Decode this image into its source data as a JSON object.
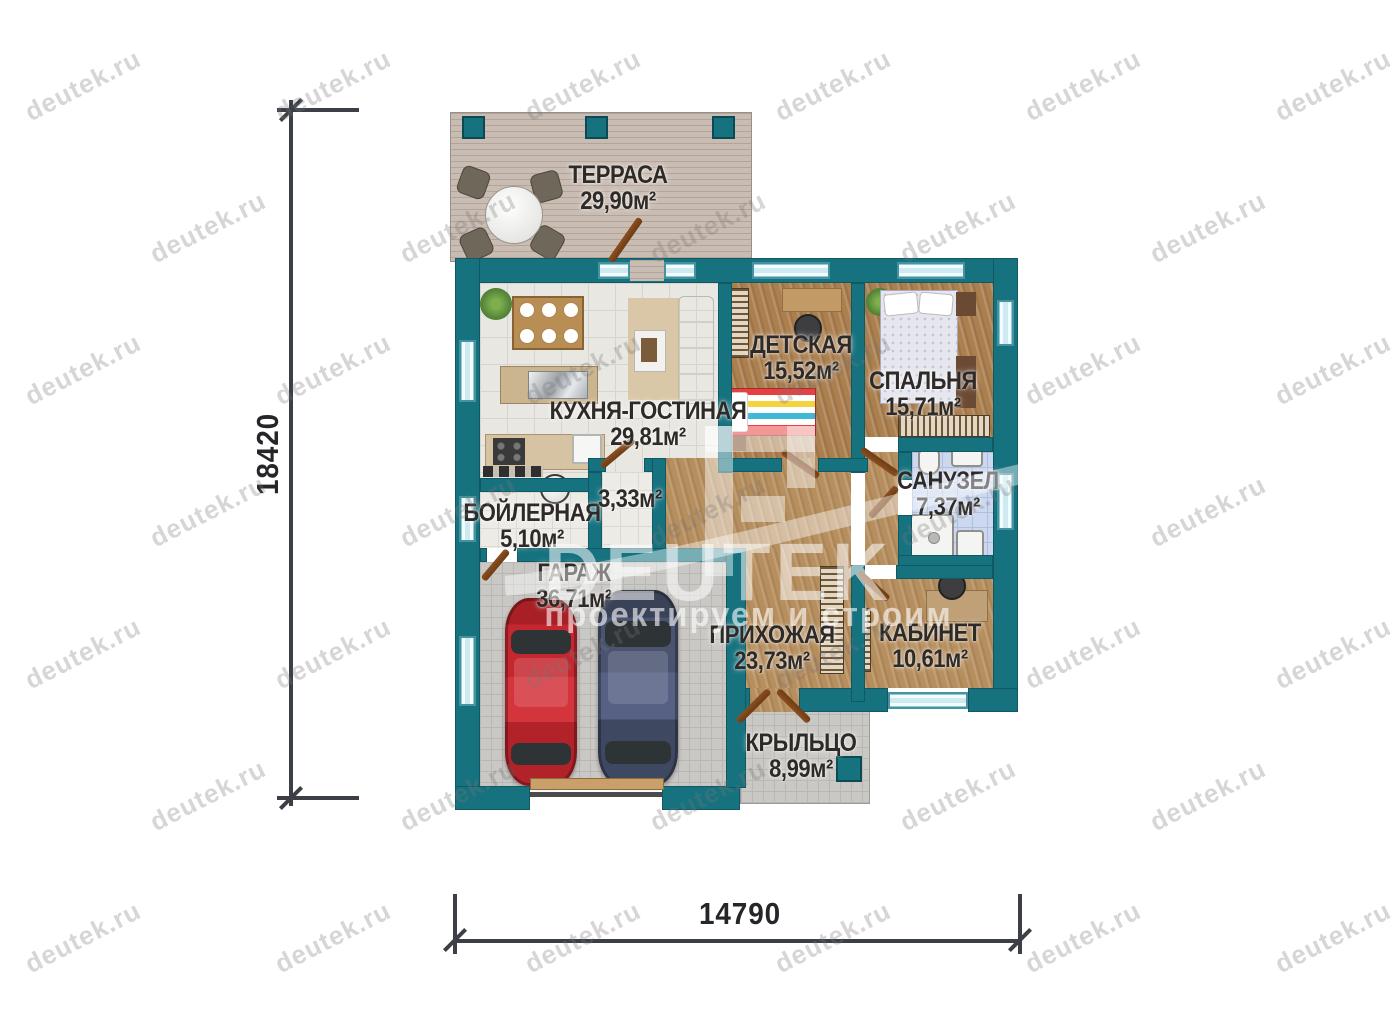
{
  "watermark": {
    "site": "deutek.ru",
    "brand": "DEUTEK",
    "slogan": "проектируем и строим"
  },
  "dimensions": {
    "vertical": "18420",
    "horizontal": "14790"
  },
  "rooms": {
    "terrace": {
      "name": "ТЕРРАСА",
      "area": "29,90м²"
    },
    "kitchen_living": {
      "name": "КУХНЯ-ГОСТИНАЯ",
      "area": "29,81м²"
    },
    "children": {
      "name": "ДЕТСКАЯ",
      "area": "15,52м²"
    },
    "bedroom": {
      "name": "СПАЛЬНЯ",
      "area": "15,71м²"
    },
    "bathroom": {
      "name": "САНУЗЕЛ",
      "area": "7,37м²"
    },
    "boiler": {
      "name": "БОЙЛЕРНАЯ",
      "area": "5,10м²"
    },
    "storage": {
      "name": "",
      "area": "3,33м²"
    },
    "garage": {
      "name": "ГАРАЖ",
      "area": "36,71м²"
    },
    "hallway": {
      "name": "ПРИХОЖАЯ",
      "area": "23,73м²"
    },
    "office": {
      "name": "КАБИНЕТ",
      "area": "10,61м²"
    },
    "porch": {
      "name": "КРЫЛЬЦО",
      "area": "8,99м²"
    }
  },
  "colors": {
    "wall": "#16727F",
    "window": "#CFE9F0",
    "deck": "#C9BCB2",
    "wood": "#AB7F4E",
    "tile": "#E9E7E1",
    "pavers": "#C9C8C4",
    "bath_tile": "#CCD8EF",
    "door": "#7C451C",
    "dimension_line": "#3C4046",
    "label_text": "#2E2A27",
    "car_red": "#C02730",
    "car_blue": "#454E66"
  }
}
